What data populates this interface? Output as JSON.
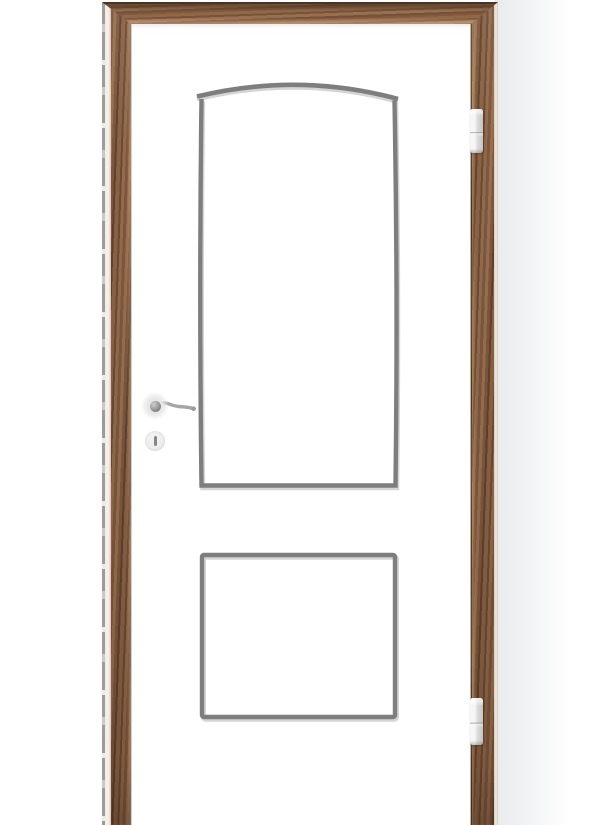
{
  "scene": {
    "type": "product-photo",
    "subject": "White interior door with two recessed panel grooves (arched top panel, rectangular bottom panel) hung in a walnut wood frame",
    "door_finish": "white",
    "frame_finish": "walnut wood grain",
    "panel_count": 2,
    "hinge_count": 2,
    "hinge_side": "right",
    "handle_side": "left"
  },
  "colors": {
    "background": "#ffffff",
    "background_shade": "#e8eaec",
    "door_white": "#ffffff",
    "groove_dark": "#7e7e7e",
    "groove_light": "#d5d5d5",
    "wood_mid": "#7d573d",
    "wood_light": "#976f4f",
    "wood_dark": "#60422c",
    "wood_top_edge": "#4a3524",
    "frame_edge_cream": "#f2ebe1",
    "seal_gray": "#9c9c9c",
    "hinge_silver_light": "#f6f6f6",
    "hinge_silver_dark": "#c3c3c3",
    "handle_metal": "#a6a6a6",
    "escutcheon_light": "#ededed",
    "keyhole_slot": "#868686"
  },
  "components": {
    "frame_header": "wood frame header",
    "frame_leg_left": "wood frame left leg",
    "frame_leg_right": "wood frame right leg",
    "door_leaf": "white door leaf",
    "upper_panel": "arched recessed panel groove",
    "lower_panel": "rectangular recessed panel groove",
    "hinge_top": "top hinge",
    "hinge_bottom": "bottom hinge",
    "lever_handle": "lever door handle",
    "keyhole": "round keyhole escutcheon"
  }
}
